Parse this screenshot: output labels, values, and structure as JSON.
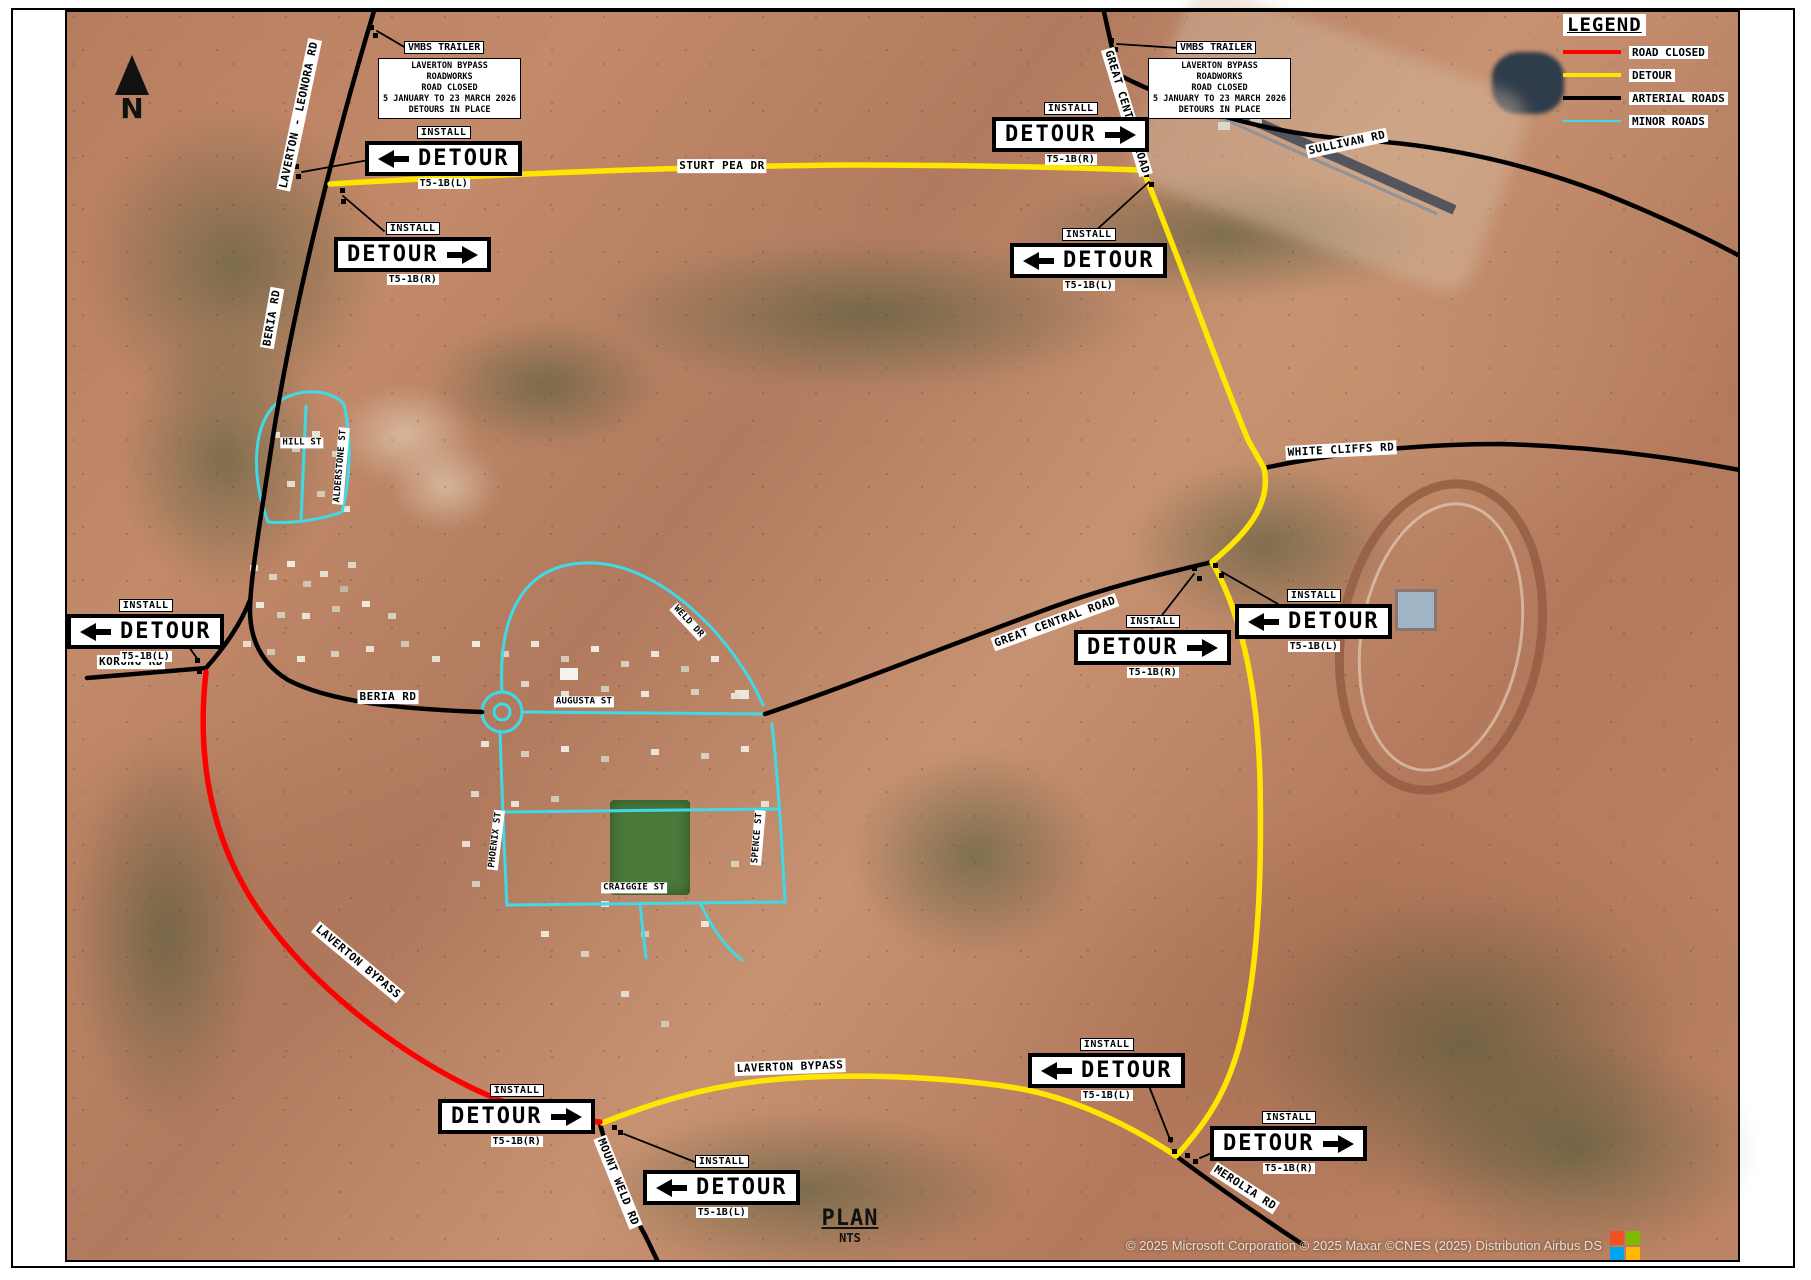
{
  "page": {
    "plan_title": "PLAN",
    "plan_scale": "NTS",
    "north_label": "N",
    "attribution": "© 2025 Microsoft Corporation © 2025 Maxar ©CNES (2025) Distribution Airbus DS",
    "logo_colors": {
      "tl": "#f25022",
      "tr": "#7fba00",
      "bl": "#00a4ef",
      "br": "#ffb900"
    }
  },
  "legend": {
    "title": "LEGEND",
    "items": [
      {
        "label": "ROAD CLOSED",
        "color": "#ff0000"
      },
      {
        "label": "DETOUR",
        "color": "#ffe600"
      },
      {
        "label": "ARTERIAL ROADS",
        "color": "#000000"
      },
      {
        "label": "MINOR ROADS",
        "color": "#3fd9e8"
      }
    ]
  },
  "vmbs": [
    {
      "callout": "VMBS TRAILER",
      "lines": [
        "LAVERTON BYPASS",
        "ROADWORKS",
        "ROAD CLOSED",
        "5 JANUARY TO 23 MARCH 2026",
        "DETOURS IN PLACE"
      ]
    },
    {
      "callout": "VMBS TRAILER",
      "lines": [
        "LAVERTON BYPASS",
        "ROADWORKS",
        "ROAD CLOSED",
        "5 JANUARY TO 23 MARCH 2026",
        "DETOURS IN PLACE"
      ]
    }
  ],
  "signs": [
    {
      "install": "INSTALL",
      "label": "DETOUR",
      "dir": "left",
      "code": "T5-1B(L)"
    },
    {
      "install": "INSTALL",
      "label": "DETOUR",
      "dir": "right",
      "code": "T5-1B(R)"
    },
    {
      "install": "INSTALL",
      "label": "DETOUR",
      "dir": "right",
      "code": "T5-1B(R)"
    },
    {
      "install": "INSTALL",
      "label": "DETOUR",
      "dir": "left",
      "code": "T5-1B(L)"
    },
    {
      "install": "INSTALL",
      "label": "DETOUR",
      "dir": "left",
      "code": "T5-1B(L)"
    },
    {
      "install": "INSTALL",
      "label": "DETOUR",
      "dir": "right",
      "code": "T5-1B(R)"
    },
    {
      "install": "INSTALL",
      "label": "DETOUR",
      "dir": "left",
      "code": "T5-1B(L)"
    },
    {
      "install": "INSTALL",
      "label": "DETOUR",
      "dir": "right",
      "code": "T5-1B(R)"
    },
    {
      "install": "INSTALL",
      "label": "DETOUR",
      "dir": "left",
      "code": "T5-1B(L)"
    },
    {
      "install": "INSTALL",
      "label": "DETOUR",
      "dir": "left",
      "code": "T5-1B(L)"
    },
    {
      "install": "INSTALL",
      "label": "DETOUR",
      "dir": "right",
      "code": "T5-1B(R)"
    }
  ],
  "roads": {
    "laverton_leonora": "LAVERTON - LEONORA RD",
    "beria_upper": "BERIA RD",
    "beria_lower": "BERIA RD",
    "korong": "KORONG RD",
    "sturt_pea": "STURT PEA DR",
    "gcr_top": "GREAT CENTRAL ROAD",
    "gcr_mid": "GREAT CENTRAL ROAD",
    "sullivan": "SULLIVAN RD",
    "white_cliffs": "WHITE CLIFFS RD",
    "hill": "HILL ST",
    "alderstone": "ALDERSTONE ST",
    "weld_dr": "WELD DR",
    "augusta": "AUGUSTA ST",
    "phoenix": "PHOENIX ST",
    "spence": "SPENCE ST",
    "craiggie": "CRAIGGIE ST",
    "bypass_red": "LAVERTON BYPASS",
    "bypass_yellow": "LAVERTON BYPASS",
    "mount_weld": "MOUNT WELD RD",
    "merolia": "MEROLIA RD"
  }
}
